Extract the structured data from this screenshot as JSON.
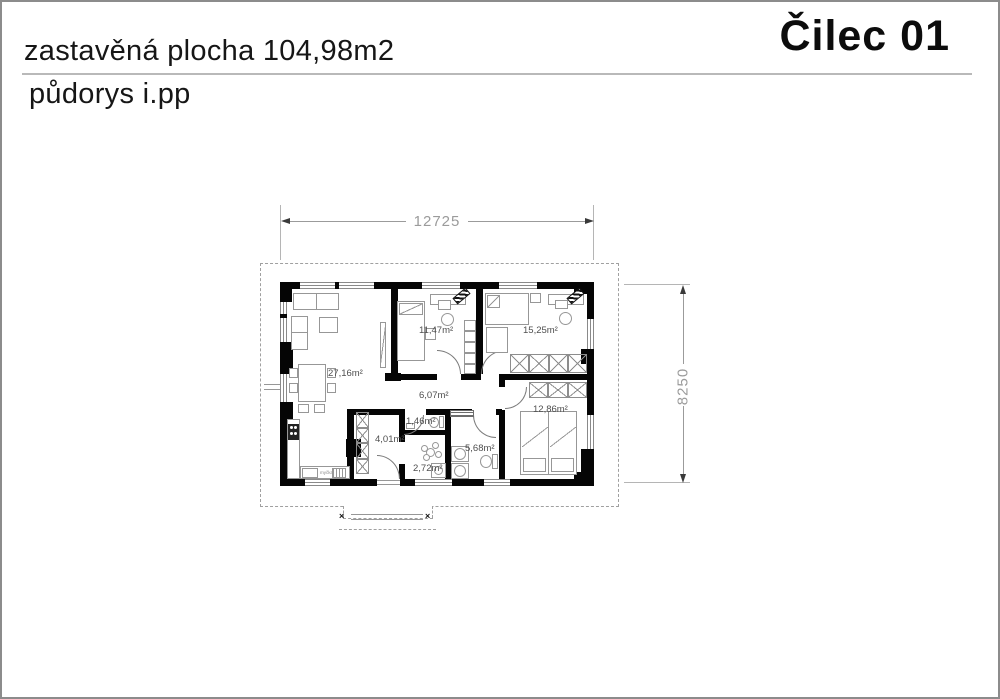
{
  "header": {
    "title": "zastavěná plocha 104,98m2",
    "subtitle": "půdorys i.pp",
    "project": "Čilec 01"
  },
  "dimensions": {
    "width": "12725",
    "height": "8250"
  },
  "rooms": {
    "living": "27,16m²",
    "bedroom1": "11,47m²",
    "bedroom2": "15,25m²",
    "hall": "6,07m²",
    "bedroom3": "12,86m²",
    "closet": "4,01m²",
    "wc": "1,46m²",
    "tech": "2,72m²",
    "bath": "5,68m²"
  },
  "labels": {
    "dishwasher": "myčka"
  },
  "colors": {
    "wall": "#050505",
    "dimension_text": "#9b9b9b",
    "furniture_stroke": "#979797",
    "roof_outline": "#a0a0a0",
    "room_label_text": "#4f4f4f",
    "page_border": "#8c8c8c"
  }
}
